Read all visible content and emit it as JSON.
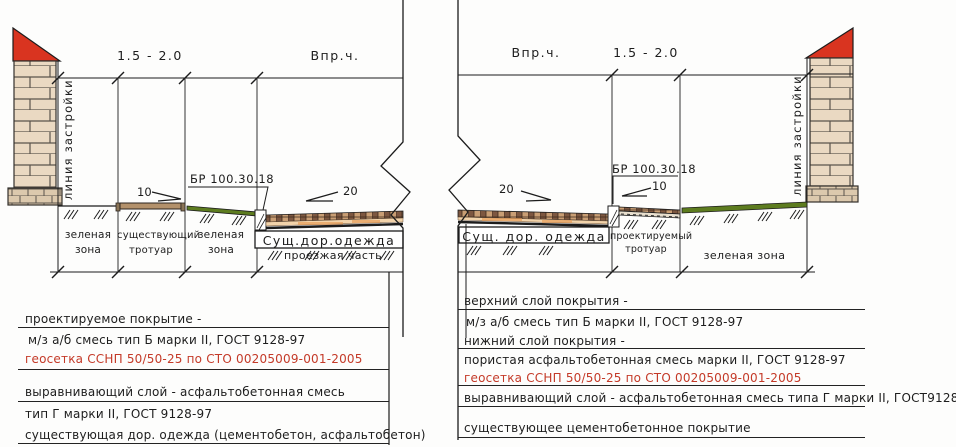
{
  "dim_labels": {
    "left_sidewalk": "1.5 - 2.0",
    "left_road": "Впр.ч.",
    "right_road": "Впр.ч.",
    "right_sidewalk": "1.5 - 2.0"
  },
  "annotations": {
    "building_line_left": "линия застройки",
    "building_line_right": "линия застройки",
    "curb_left": "БР 100.30.18",
    "curb_right": "БР 100.30.18",
    "slope_sidewalk_left": "10",
    "slope_road_left": "20",
    "slope_road_right": "20",
    "slope_sidewalk_right": "10",
    "existing_pavement_left": "Сущ.дор.одежда",
    "existing_pavement_right": "Сущ. дор. одежда"
  },
  "zones_left": [
    {
      "line1": "зеленая",
      "line2": "зона"
    },
    {
      "line1": "существующий",
      "line2": "тротуар"
    },
    {
      "line1": "зеленая",
      "line2": "зона"
    },
    {
      "line1": "проезжая часть",
      "line2": ""
    }
  ],
  "zones_right": [
    {
      "line1": "проектируемый",
      "line2": "тротуар"
    },
    {
      "line1": "зеленая зона",
      "line2": ""
    }
  ],
  "notes_left": [
    {
      "text": "проектируемое покрытие -"
    },
    {
      "text": "м/з а/б смесь тип Б марки II, ГОСТ 9128-97"
    },
    {
      "text": "геосетка ССНП 50/50-25 по СТО 00205009-001-2005"
    },
    {
      "text": "выравнивающий слой - асфальтобетонная смесь"
    },
    {
      "text": "тип Г марки II, ГОСТ 9128-97"
    },
    {
      "text": "существующая дор. одежда (цементобетон, асфальтобетон)"
    }
  ],
  "notes_right": [
    {
      "text": "верхний слой покрытия -"
    },
    {
      "text": "м/з а/б смесь тип Б марки II, ГОСТ 9128-97"
    },
    {
      "text": "нижний слой покрытия -"
    },
    {
      "text": "пористая асфальтобетонная смесь марки II, ГОСТ 9128-97"
    },
    {
      "text": "геосетка ССНП 50/50-25 по СТО 00205009-001-2005"
    },
    {
      "text": "выравнивающий слой - асфальтобетонная смесь типа Г марки II, ГОСТ9128-97"
    },
    {
      "text": "существующее цементобетонное покрытие"
    }
  ],
  "colors": {
    "roof_red": "#d93420",
    "green_strip": "#5d7c1f",
    "note_red_text": "#c43a28",
    "line": "#1c1c1c"
  }
}
